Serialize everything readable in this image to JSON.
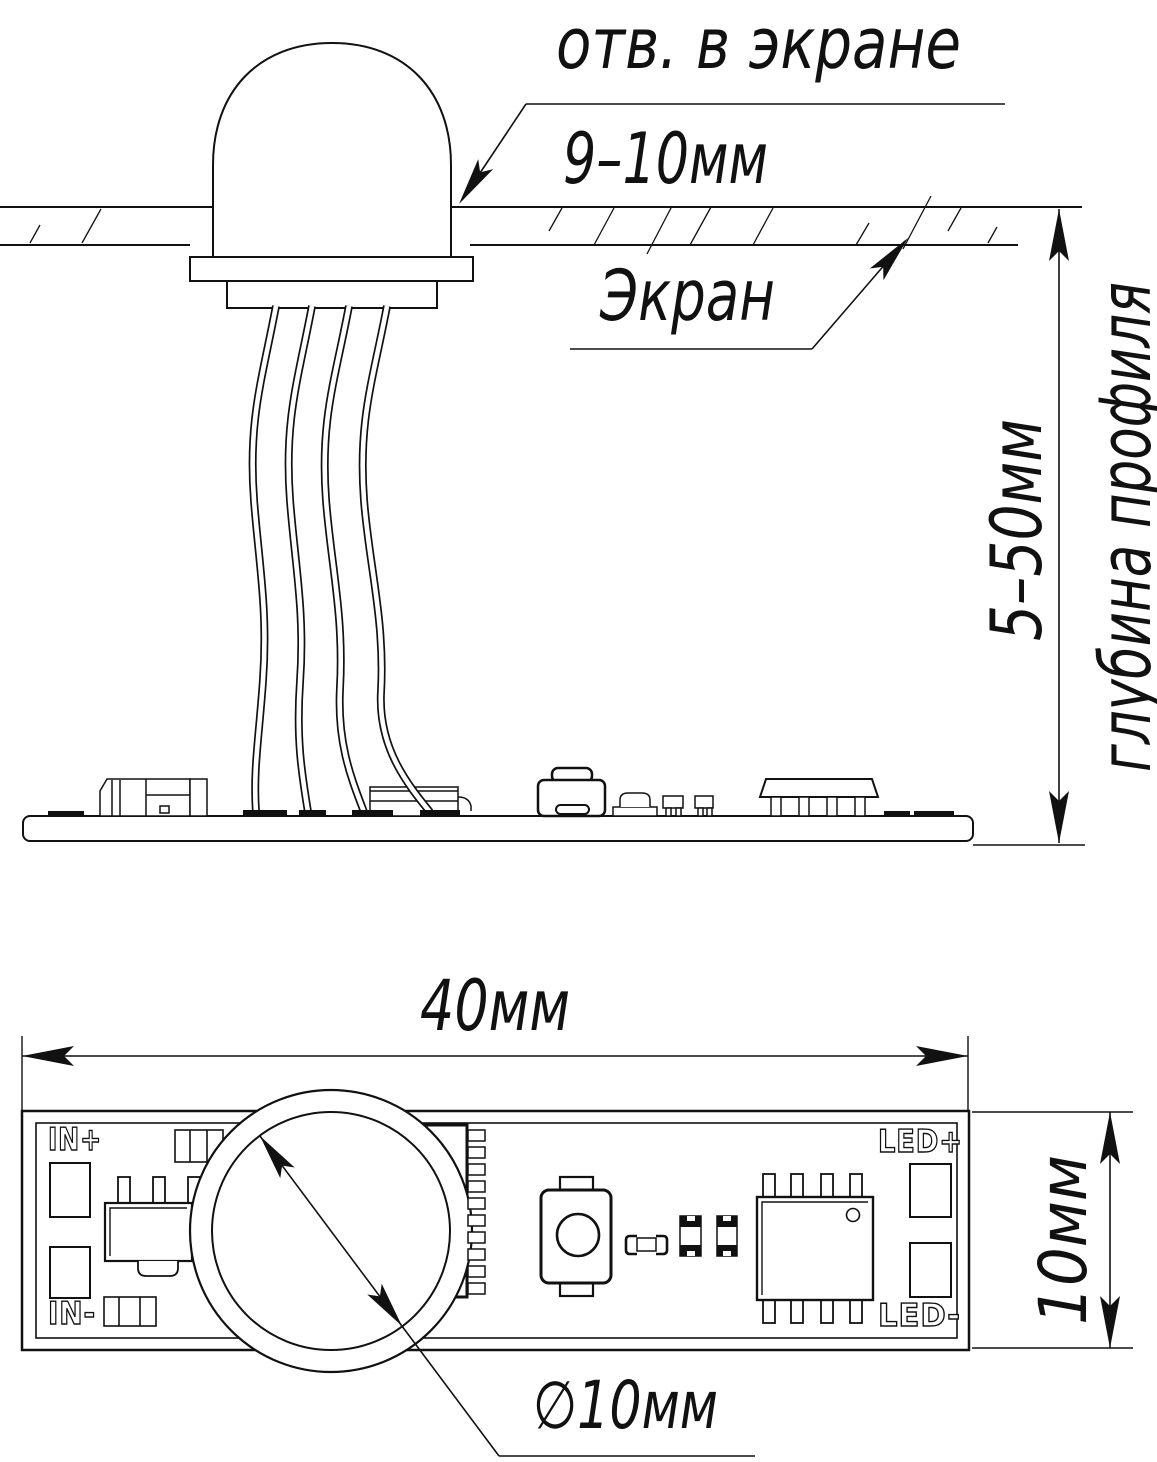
{
  "drawing": {
    "callouts": {
      "hole_note": "отв. в экране",
      "hole_size": "9–10мм",
      "screen_label": "Экран",
      "diameter_label": "∅10мм"
    },
    "dimensions": {
      "depth_range": "5–50мм",
      "depth_note": "глубина профиля",
      "board_width": "40мм",
      "board_height": "10мм"
    },
    "pcb_labels": {
      "in_plus": "IN+",
      "in_minus": "IN-",
      "led_plus": "LED+",
      "led_minus": "LED-"
    },
    "colors": {
      "line": "#111111",
      "background": "#ffffff"
    }
  }
}
